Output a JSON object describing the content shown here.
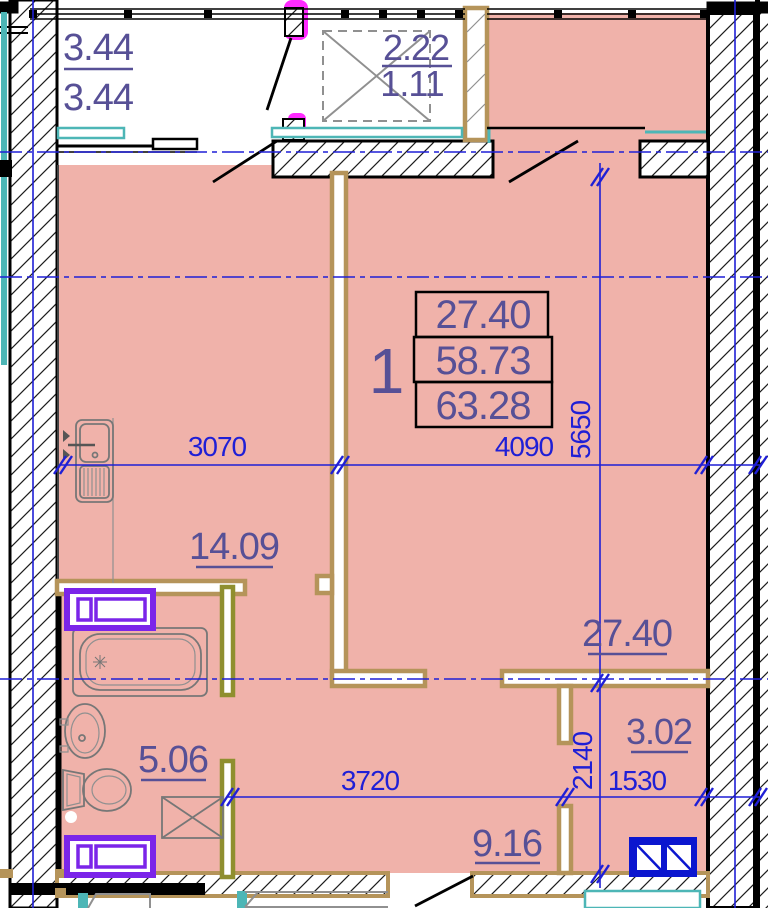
{
  "document": {
    "type": "apartment-floor-plan"
  },
  "unit": {
    "number": "1",
    "area_table": {
      "living_area": "27.40",
      "apartment_area": "58.73",
      "total_area": "63.28"
    }
  },
  "rooms": {
    "living_room": "27.40",
    "kitchen": "14.09",
    "bathroom": "5.06",
    "hall": "9.16",
    "storage": "3.02"
  },
  "balconies": {
    "left": {
      "numerator": "3.44",
      "denominator": "3.44"
    },
    "middle": {
      "numerator": "2.22",
      "denominator": "1.11"
    }
  },
  "dimensions": {
    "kitchen_width": "3070",
    "living_width": "4090",
    "living_height": "5650",
    "hall_width": "3720",
    "storage_width": "1530",
    "storage_height": "2140"
  },
  "colors": {
    "room_fill": "#f0b2aa",
    "dim_blue": "#1f1fd6",
    "label_purple": "#575096",
    "wall_tan": "#b5945a",
    "wall_olive": "#8f8f2f",
    "fixture_purple": "#7b25e9",
    "teal": "#4db6b6",
    "magenta": "#ff2bff",
    "cabinet_blue": "#0b16cf"
  }
}
